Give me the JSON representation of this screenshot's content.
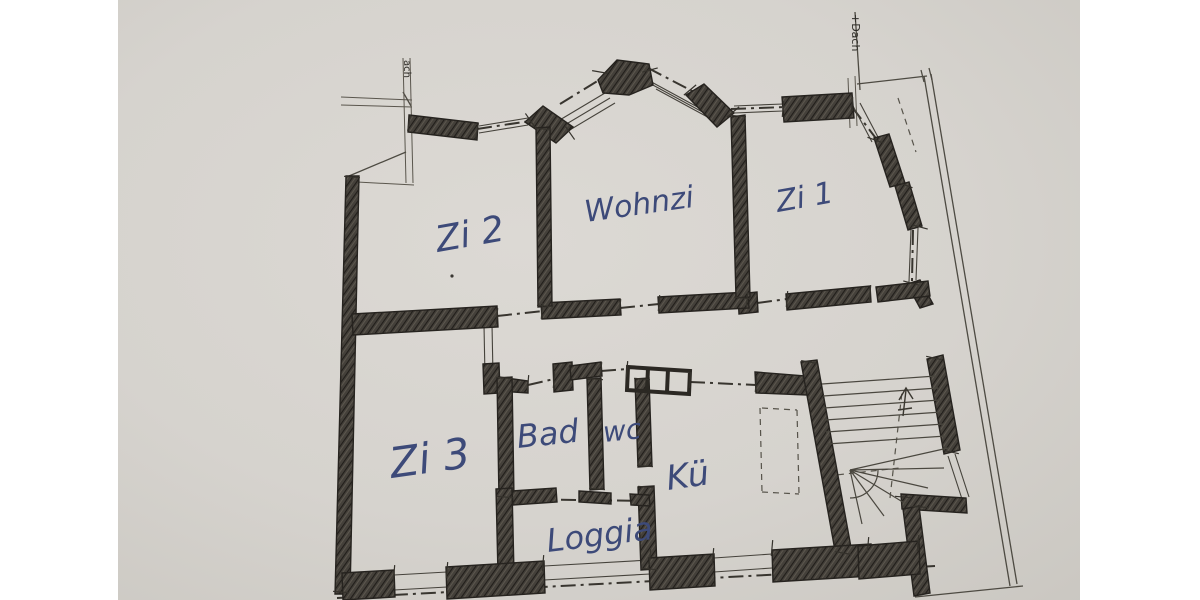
{
  "rooms": [
    {
      "id": "zi2",
      "label": "Zi 2"
    },
    {
      "id": "wohnzi",
      "label": "Wohnzi"
    },
    {
      "id": "zi1",
      "label": "Zi 1"
    },
    {
      "id": "zi3",
      "label": "Zi 3"
    },
    {
      "id": "bad",
      "label": "Bad"
    },
    {
      "id": "wc",
      "label": "wc"
    },
    {
      "id": "kue",
      "label": "Kü"
    },
    {
      "id": "loggia",
      "label": "Loggia"
    }
  ],
  "annotations": {
    "roof_note_right": "+Dach",
    "roof_note_left": "ach"
  },
  "colors": {
    "page_background": "#ffffff",
    "paper": "#d8d5d0",
    "ink": "#34312b",
    "handwriting_blue": "#3d4a79"
  }
}
